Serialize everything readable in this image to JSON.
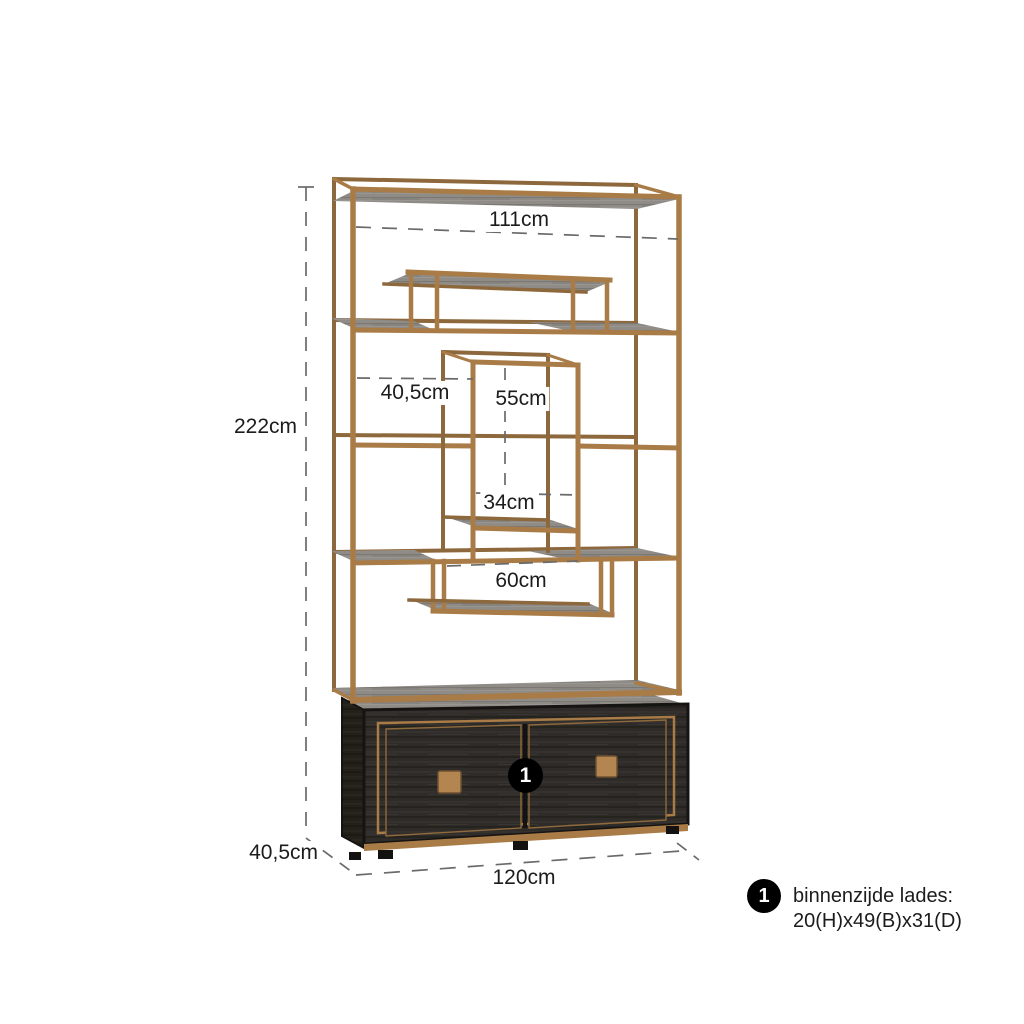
{
  "colors": {
    "background": "#ffffff",
    "brass": "#a97c47",
    "brass_dark": "#8d683c",
    "wood_grey": "#8f8b86",
    "cabinet_black": "#2d2a27",
    "dash_line": "#6a6a6a",
    "text": "#1c1c1c",
    "badge_bg": "#000000",
    "badge_text": "#ffffff"
  },
  "diagram": {
    "labels": {
      "height": "222cm",
      "top_inner_width": "111cm",
      "left_compartment_depth": "40,5cm",
      "box_height": "55cm",
      "box_width": "34cm",
      "bridge_shelf_width": "60cm",
      "base_depth": "40,5cm",
      "base_width": "120cm"
    },
    "badge": {
      "label": "1"
    },
    "note": {
      "marker": "1",
      "line1": "binnenzijde lades:",
      "line2": "20(H)x49(B)x31(D)"
    }
  }
}
